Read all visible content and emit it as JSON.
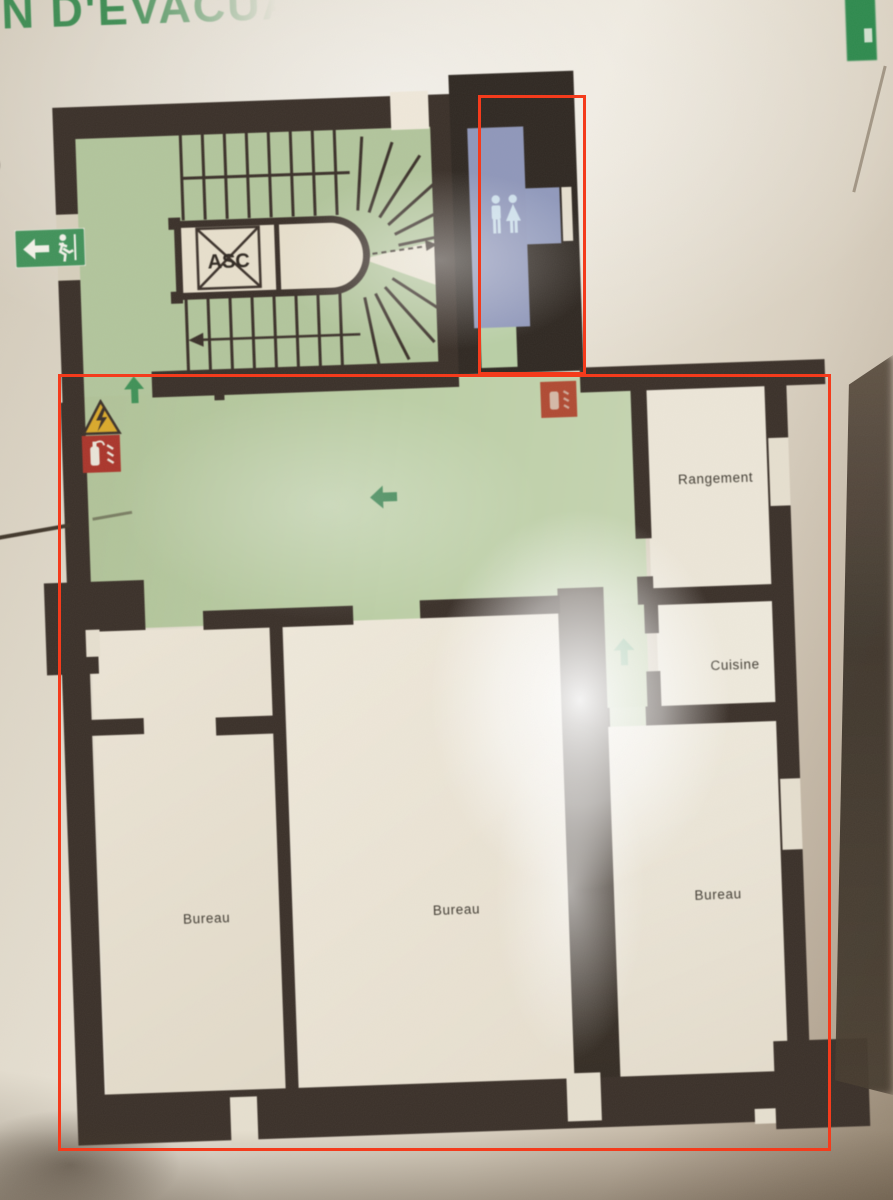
{
  "photo": {
    "title_fragment": "AN D'ÉVACUATION",
    "side_letter_fragment": "S"
  },
  "plan": {
    "elevator_label": "ASC",
    "rooms": [
      {
        "label": "Rangement"
      },
      {
        "label": "Cuisine"
      },
      {
        "label": "Bureau"
      },
      {
        "label": "Bureau"
      },
      {
        "label": "Bureau"
      }
    ],
    "icons": {
      "exit_sign": "running-man-with-left-arrow",
      "evacuation_arrows": "green-directional-arrows",
      "extinguisher_signs": "red-fire-extinguisher-squares",
      "warning_sign": "yellow-warning-triangle",
      "wc_pictogram": "two-person-toilet-figures",
      "elevator_cross": "x-crossed-elevator-box"
    },
    "colors": {
      "floor_green": "#b3c69c",
      "wall_dark": "#3a3029",
      "wc_blue": "#8f97ba",
      "title_green": "#3f8d54",
      "annotation_red": "#f43b1c"
    }
  },
  "annotations": {
    "boxes": [
      {
        "name": "wc-area-box"
      },
      {
        "name": "main-floor-box"
      }
    ]
  }
}
